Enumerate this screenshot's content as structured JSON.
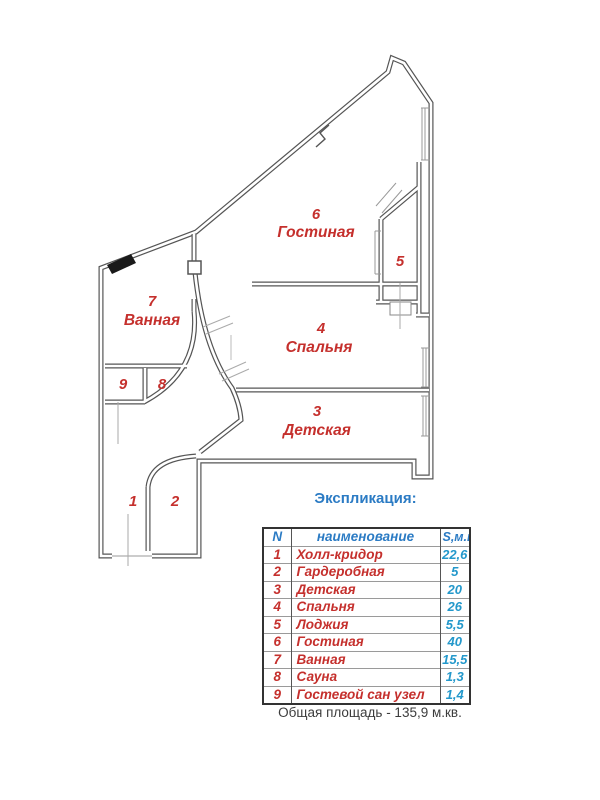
{
  "plan": {
    "rooms": [
      {
        "num": "6",
        "label": "Гостиная"
      },
      {
        "num": "5",
        "label": ""
      },
      {
        "num": "4",
        "label": "Спальня"
      },
      {
        "num": "3",
        "label": "Детская"
      },
      {
        "num": "7",
        "label": "Ванная"
      },
      {
        "num": "9",
        "label": ""
      },
      {
        "num": "8",
        "label": ""
      },
      {
        "num": "1",
        "label": ""
      },
      {
        "num": "2",
        "label": ""
      }
    ]
  },
  "legend": {
    "title": "Экспликация:",
    "columns": [
      "N",
      "наименование",
      "S,м.кв."
    ],
    "rows": [
      [
        "1",
        "Холл-кридор",
        "22,6"
      ],
      [
        "2",
        "Гардеробная",
        "5"
      ],
      [
        "3",
        "Детская",
        "20"
      ],
      [
        "4",
        "Спальня",
        "26"
      ],
      [
        "5",
        "Лоджия",
        "5,5"
      ],
      [
        "6",
        "Гостиная",
        "40"
      ],
      [
        "7",
        "Ванная",
        "15,5"
      ],
      [
        "8",
        "Сауна",
        "1,3"
      ],
      [
        "9",
        "Гостевой сан узел",
        "1,4"
      ]
    ]
  },
  "footer": {
    "total_label": "Общая площадь -  135,9 м.кв."
  },
  "colors": {
    "room_label": "#c5302d",
    "legend_header": "#2b7bc4",
    "legend_value": "#2398cb",
    "wall": "#555555"
  }
}
